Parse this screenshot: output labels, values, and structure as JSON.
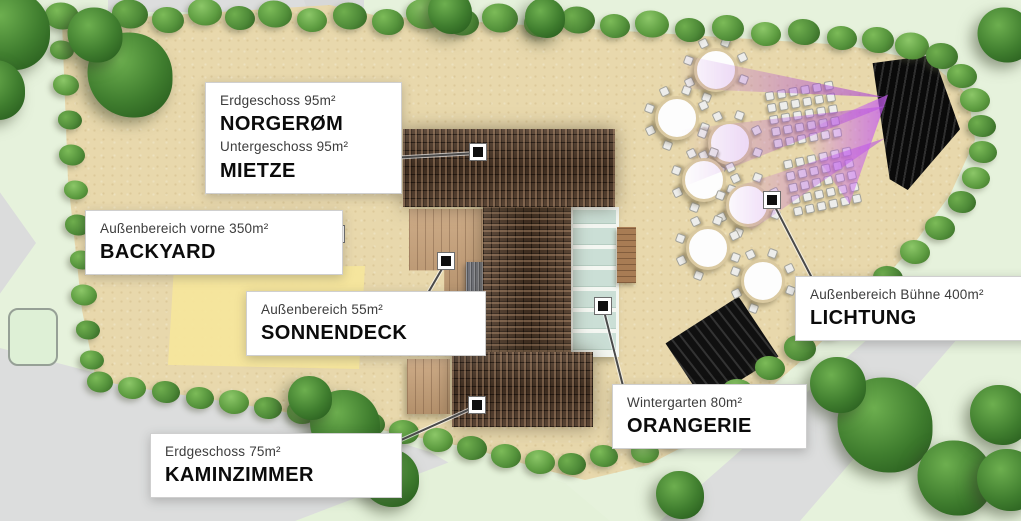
{
  "palette": {
    "grass": "#e4f1d9",
    "sand": "#e8d8ac",
    "road": "#dcdddd",
    "yellow_lawn": "#f6e69c",
    "hedge_green": "#5f9e42",
    "roof_brown": "#4e3827",
    "deck_wood": "#c7a077",
    "conservatory_glass": "#cbdfd6",
    "stage_black": "#141414",
    "stage_light_purple": "#aa42d6",
    "callout_bg": "#ffffff",
    "callout_text": "#0b0b0b",
    "callout_subtext": "#3c3c3c"
  },
  "map": {
    "callouts": [
      {
        "id": "norgerom-mietze",
        "lines": [
          {
            "small": "Erdgeschoss 95m²",
            "big": "NORGERØM"
          },
          {
            "small": "Untergeschoss 95m²",
            "big": "MIETZE"
          }
        ],
        "box": {
          "x": 205,
          "y": 82,
          "w": 167
        },
        "anchor": {
          "x": 373,
          "y": 158
        },
        "marker": {
          "x": 478,
          "y": 152
        }
      },
      {
        "id": "backyard",
        "lines": [
          {
            "small": "Außenbereich vorne 350m²",
            "big": "BACKYARD"
          }
        ],
        "box": {
          "x": 85,
          "y": 210,
          "w": 228
        },
        "anchor": {
          "x": 314,
          "y": 243
        },
        "marker": {
          "x": 336,
          "y": 234
        }
      },
      {
        "id": "sonnendeck",
        "lines": [
          {
            "small": "Außenbereich 55m²",
            "big": "SONNENDECK"
          }
        ],
        "box": {
          "x": 246,
          "y": 291,
          "w": 210
        },
        "anchor": {
          "x": 428,
          "y": 292
        },
        "marker": {
          "x": 446,
          "y": 261
        }
      },
      {
        "id": "kaminzimmer",
        "lines": [
          {
            "small": "Erdgeschoss 75m²",
            "big": "KAMINZIMMER"
          }
        ],
        "box": {
          "x": 150,
          "y": 433,
          "w": 222
        },
        "anchor": {
          "x": 372,
          "y": 452
        },
        "marker": {
          "x": 477,
          "y": 405
        }
      },
      {
        "id": "orangerie",
        "lines": [
          {
            "small": "Wintergarten 80m²",
            "big": "ORANGERIE"
          }
        ],
        "box": {
          "x": 612,
          "y": 384,
          "w": 165
        },
        "anchor": {
          "x": 623,
          "y": 385
        },
        "marker": {
          "x": 603,
          "y": 306
        }
      },
      {
        "id": "lichtung",
        "lines": [
          {
            "small": "Außenbereich Bühne 400m²",
            "big": "LICHTUNG"
          }
        ],
        "box": {
          "x": 795,
          "y": 276,
          "w": 206
        },
        "anchor": {
          "x": 812,
          "y": 277
        },
        "marker": {
          "x": 772,
          "y": 200
        }
      }
    ],
    "round_tables": {
      "chairs_per_table": 7,
      "positions": [
        {
          "x": 716,
          "y": 70
        },
        {
          "x": 677,
          "y": 118
        },
        {
          "x": 730,
          "y": 143
        },
        {
          "x": 704,
          "y": 180
        },
        {
          "x": 748,
          "y": 205
        },
        {
          "x": 708,
          "y": 248
        },
        {
          "x": 763,
          "y": 281
        }
      ]
    },
    "chair_blocks": [
      {
        "x": 769,
        "y": 86,
        "rows": 5,
        "cols": 6,
        "angle": -10
      },
      {
        "x": 788,
        "y": 153,
        "rows": 5,
        "cols": 6,
        "angle": -12
      }
    ],
    "vegetation": {
      "hedge_top": [
        [
          62,
          16,
          34
        ],
        [
          95,
          22,
          30
        ],
        [
          130,
          14,
          36
        ],
        [
          168,
          20,
          32
        ],
        [
          205,
          12,
          34
        ],
        [
          240,
          18,
          30
        ],
        [
          275,
          14,
          34
        ],
        [
          312,
          20,
          30
        ],
        [
          350,
          16,
          34
        ],
        [
          388,
          22,
          32
        ],
        [
          425,
          14,
          38
        ],
        [
          462,
          22,
          34
        ],
        [
          500,
          18,
          36
        ],
        [
          540,
          24,
          32
        ],
        [
          578,
          20,
          34
        ],
        [
          615,
          26,
          30
        ],
        [
          652,
          24,
          34
        ],
        [
          690,
          30,
          30
        ],
        [
          728,
          28,
          32
        ],
        [
          766,
          34,
          30
        ],
        [
          804,
          32,
          32
        ],
        [
          842,
          38,
          30
        ]
      ],
      "hedge_right_curve": [
        [
          878,
          40,
          32
        ],
        [
          912,
          46,
          34
        ],
        [
          942,
          56,
          32
        ],
        [
          962,
          76,
          30
        ],
        [
          975,
          100,
          30
        ],
        [
          982,
          126,
          28
        ],
        [
          983,
          152,
          28
        ],
        [
          976,
          178,
          28
        ],
        [
          962,
          202,
          28
        ],
        [
          940,
          228,
          30
        ],
        [
          915,
          252,
          30
        ],
        [
          888,
          278,
          30
        ],
        [
          860,
          302,
          32
        ],
        [
          830,
          326,
          30
        ],
        [
          800,
          348,
          32
        ],
        [
          770,
          368,
          30
        ],
        [
          738,
          392,
          32
        ],
        [
          706,
          414,
          30
        ],
        [
          674,
          436,
          30
        ],
        [
          645,
          452,
          28
        ]
      ],
      "hedge_bottom": [
        [
          100,
          382,
          26
        ],
        [
          132,
          388,
          28
        ],
        [
          166,
          392,
          28
        ],
        [
          200,
          398,
          28
        ],
        [
          234,
          402,
          30
        ],
        [
          268,
          408,
          28
        ],
        [
          302,
          412,
          30
        ],
        [
          336,
          418,
          28
        ],
        [
          370,
          424,
          30
        ],
        [
          404,
          432,
          30
        ],
        [
          438,
          440,
          30
        ],
        [
          472,
          448,
          30
        ],
        [
          506,
          456,
          30
        ],
        [
          540,
          462,
          30
        ],
        [
          572,
          464,
          28
        ],
        [
          604,
          456,
          28
        ]
      ],
      "hedge_left": [
        [
          62,
          50,
          24
        ],
        [
          66,
          85,
          26
        ],
        [
          70,
          120,
          24
        ],
        [
          72,
          155,
          26
        ],
        [
          76,
          190,
          24
        ],
        [
          78,
          225,
          26
        ],
        [
          82,
          260,
          24
        ],
        [
          84,
          295,
          26
        ],
        [
          88,
          330,
          24
        ],
        [
          92,
          360,
          24
        ]
      ],
      "trees": [
        [
          10,
          30,
          80
        ],
        [
          -5,
          90,
          60
        ],
        [
          130,
          75,
          85
        ],
        [
          95,
          35,
          55
        ],
        [
          450,
          12,
          44
        ],
        [
          545,
          18,
          40
        ],
        [
          1005,
          35,
          55
        ],
        [
          345,
          425,
          70
        ],
        [
          390,
          478,
          58
        ],
        [
          310,
          398,
          44
        ],
        [
          680,
          495,
          48
        ],
        [
          885,
          425,
          95
        ],
        [
          955,
          478,
          75
        ],
        [
          838,
          385,
          56
        ],
        [
          1000,
          415,
          60
        ],
        [
          1008,
          480,
          62
        ]
      ]
    }
  }
}
